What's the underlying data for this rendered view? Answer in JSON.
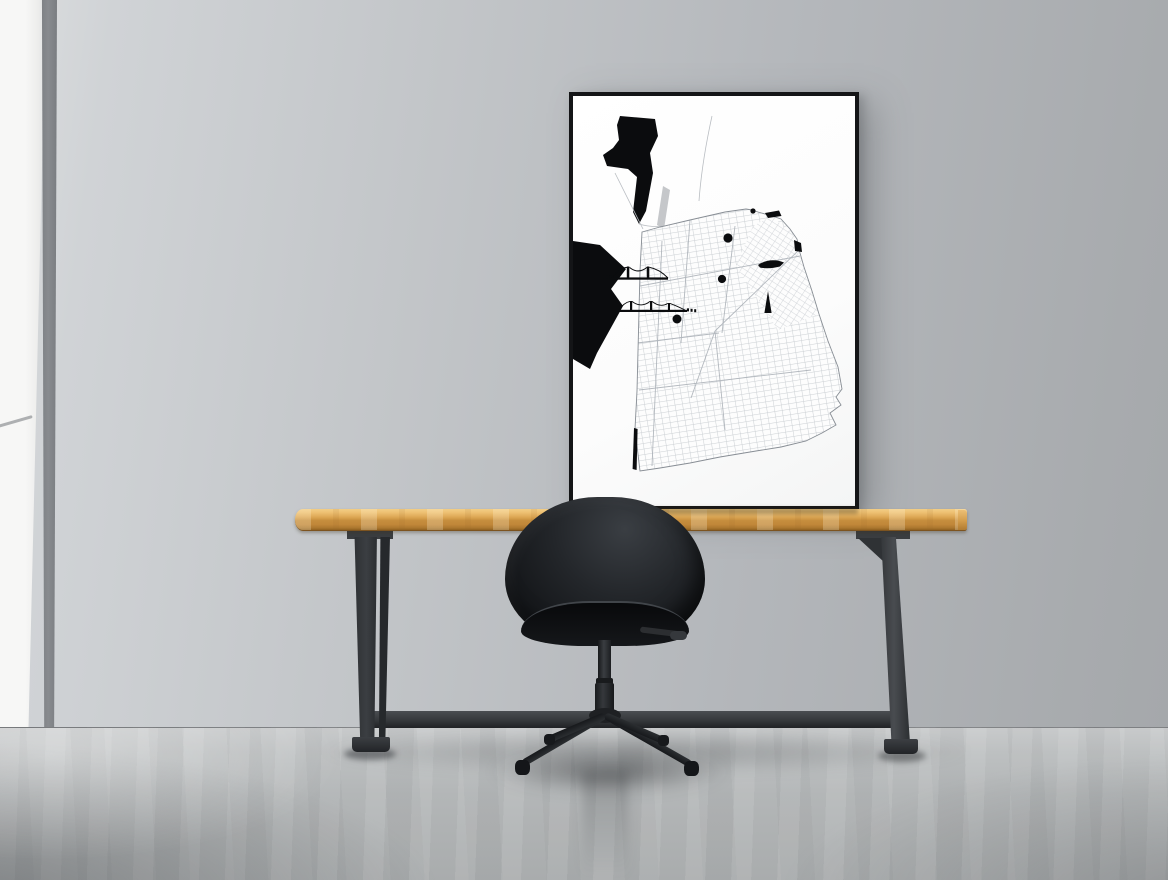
{
  "scene": {
    "kind": "interior-photo-mockup",
    "objects": {
      "poster": "framed-black-and-white-city-street-map",
      "table": "wood-top-table-with-black-metal-trestle-legs",
      "chair": "black-shell-swivel-chair-four-star-base",
      "wall": "plain-gray-wall",
      "window_light": "bright-daylight-band-left",
      "floor": "gray-concrete-floor"
    },
    "poster_art": {
      "style": "minimal-street-map-print",
      "icons": [
        "golden-gate-bridge-icon",
        "bay-bridge-icon",
        "landmark-dot",
        "ferry-ship-icon",
        "obelisk-tower-icon",
        "shore-islet-blob",
        "ocean-beach-shoreline"
      ]
    }
  },
  "palette": {
    "wall_left": "#f7f7f6",
    "wall_mid": "#c3c6c9",
    "wall_right": "#a8abae",
    "corner_stripe": "#888b8f",
    "floor_back": "#c8cacb",
    "floor_front": "#a9acad",
    "wood_top": "#eec173",
    "wood_front": "#c18739",
    "metal": "#3b3e42",
    "chair": "#1c1f22",
    "frame": "#141517",
    "poster_bg": "#fcfcfc",
    "map_grid": "#c7cbd0",
    "map_ink": "#0b0c0e"
  }
}
